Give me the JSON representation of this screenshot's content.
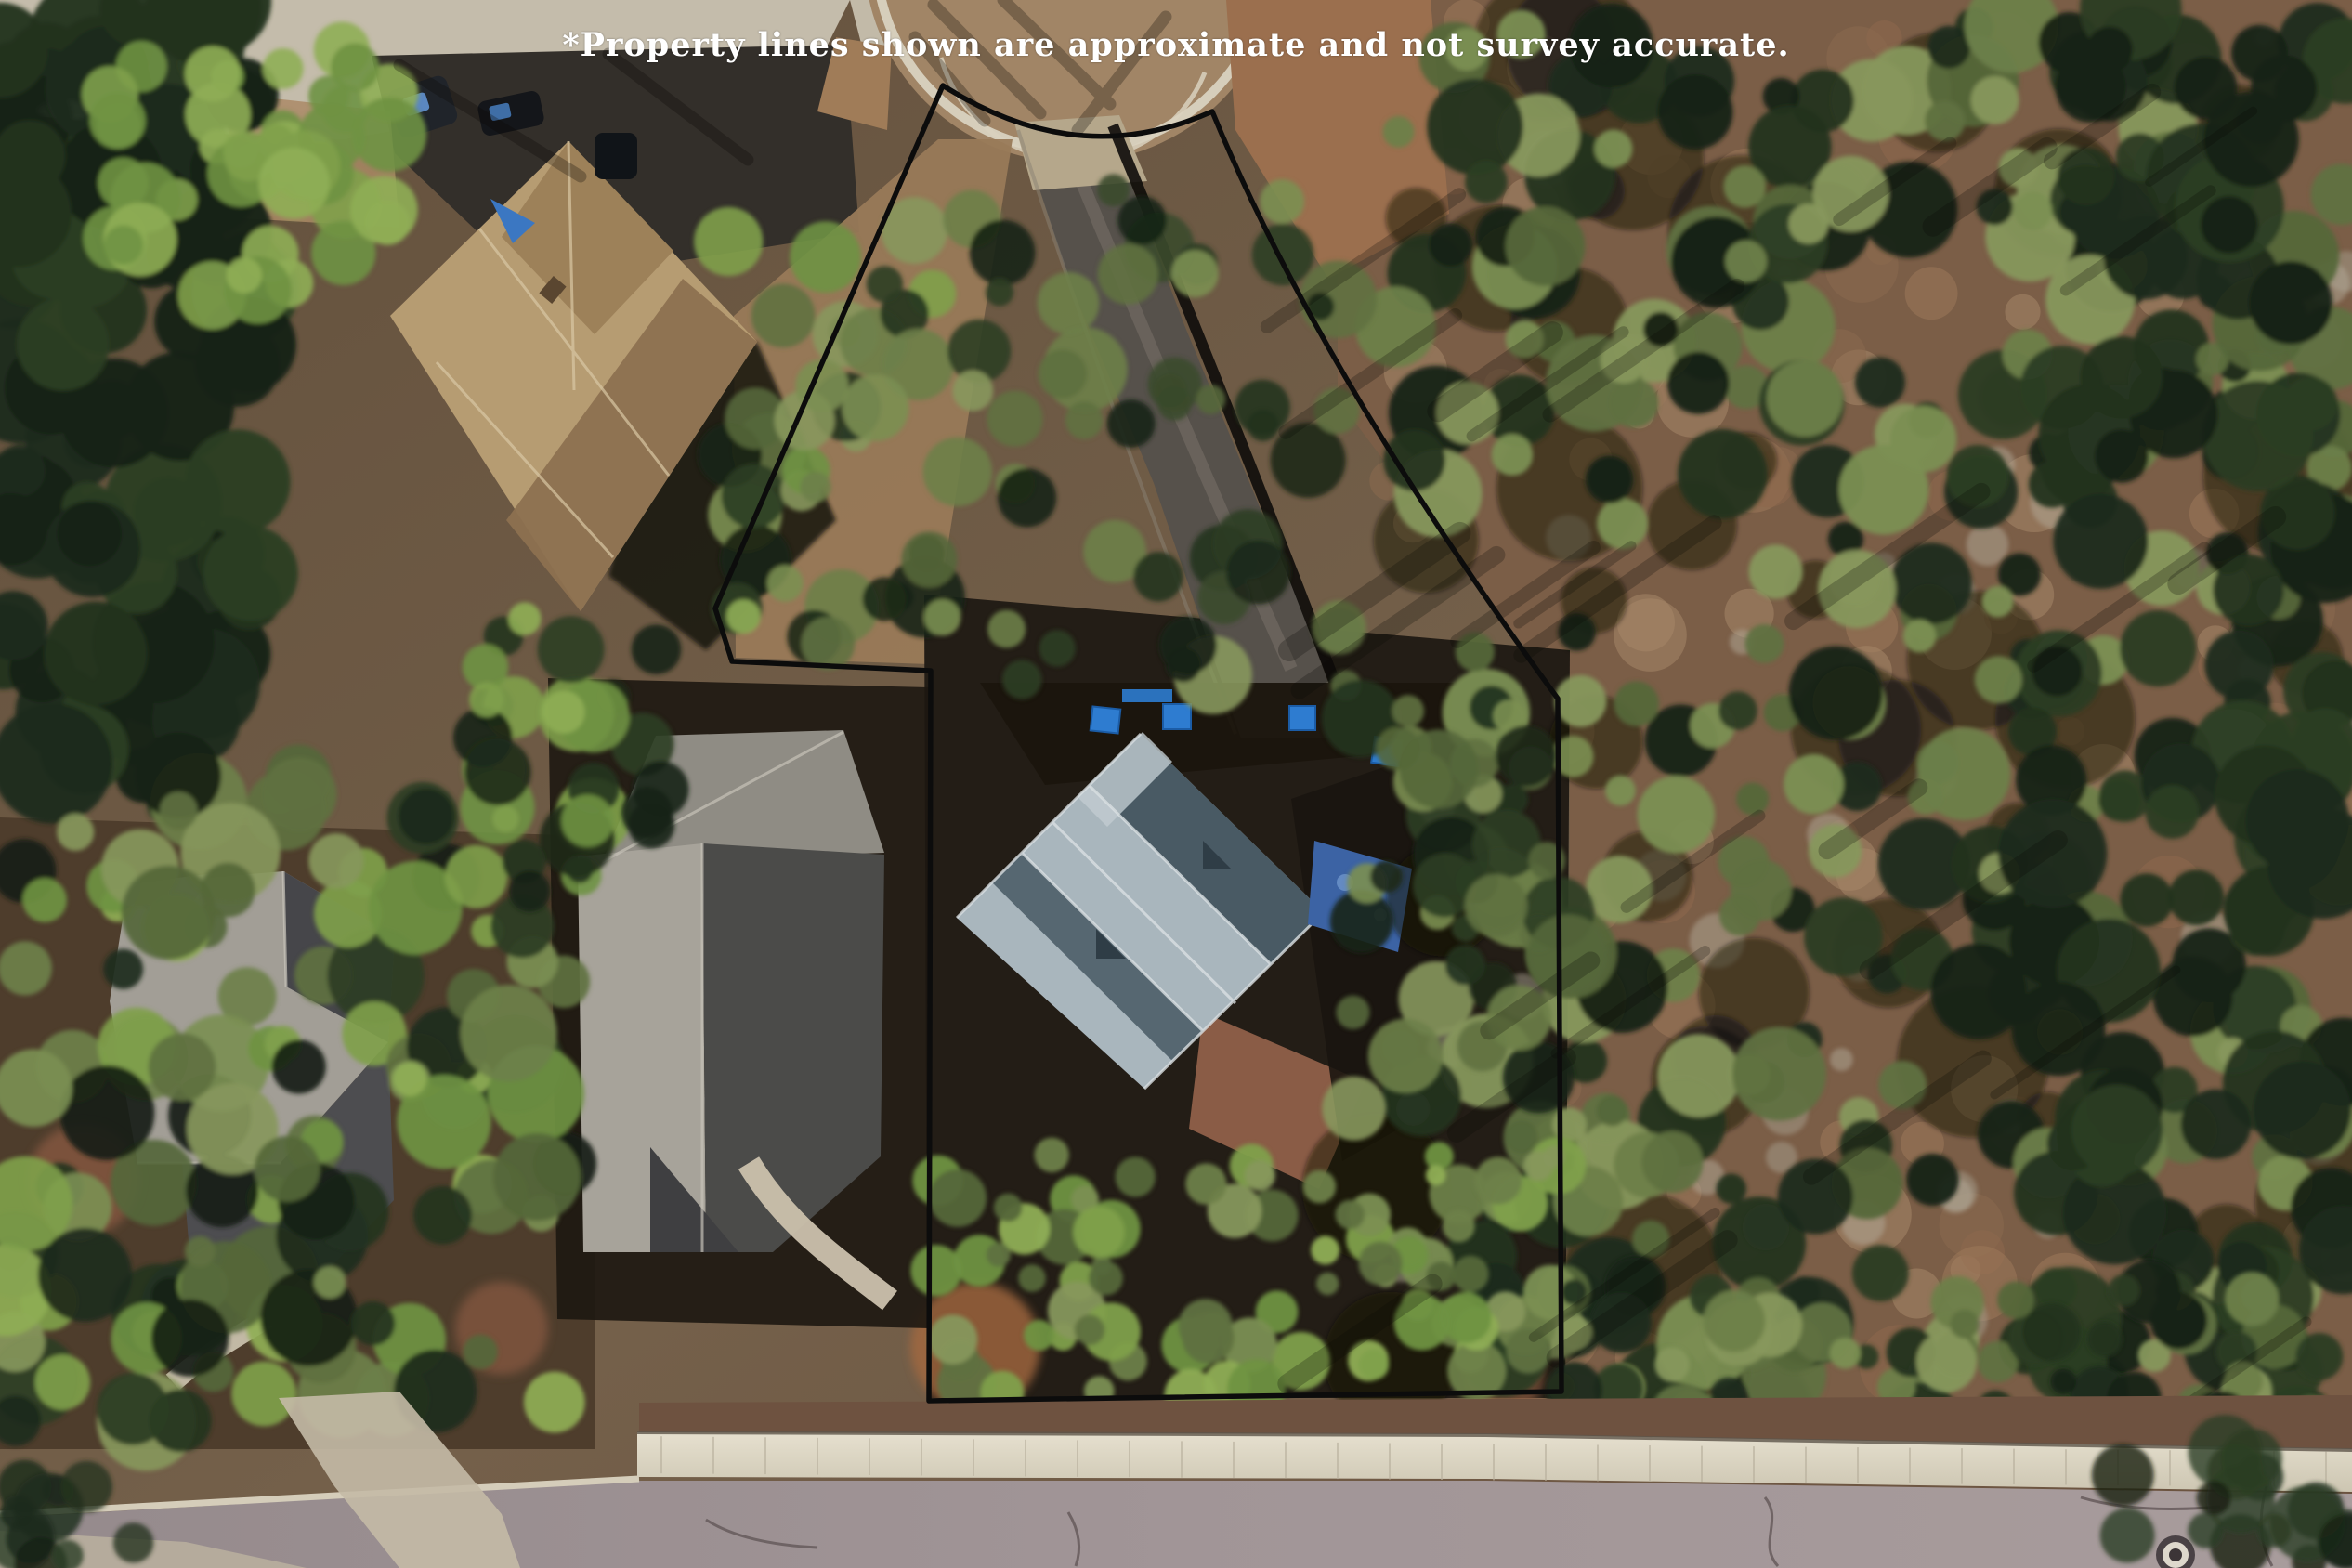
{
  "overlay": {
    "disclaimer": "*Property lines shown are approximate and not survey accurate."
  },
  "annotation": {
    "label": "property-boundary",
    "color": "#0c0c0c",
    "stroke_width": 5.5,
    "boundary_path": "M 1015,92 Q 1160,185 1305,120 Q 1420,400 1677,752 L 1681,1498 L 1000,1508 L 1002,722 L 788,712 L 770,655 Z"
  },
  "colors": {
    "disclaimer_text": "#ffffff",
    "road": "#9c9094",
    "retaining_wall": "#ddd7c6",
    "subject_roof_light": "#a9b6bd",
    "subject_roof_dark": "#495a64",
    "tarp_blue": "#2e7cd0"
  }
}
